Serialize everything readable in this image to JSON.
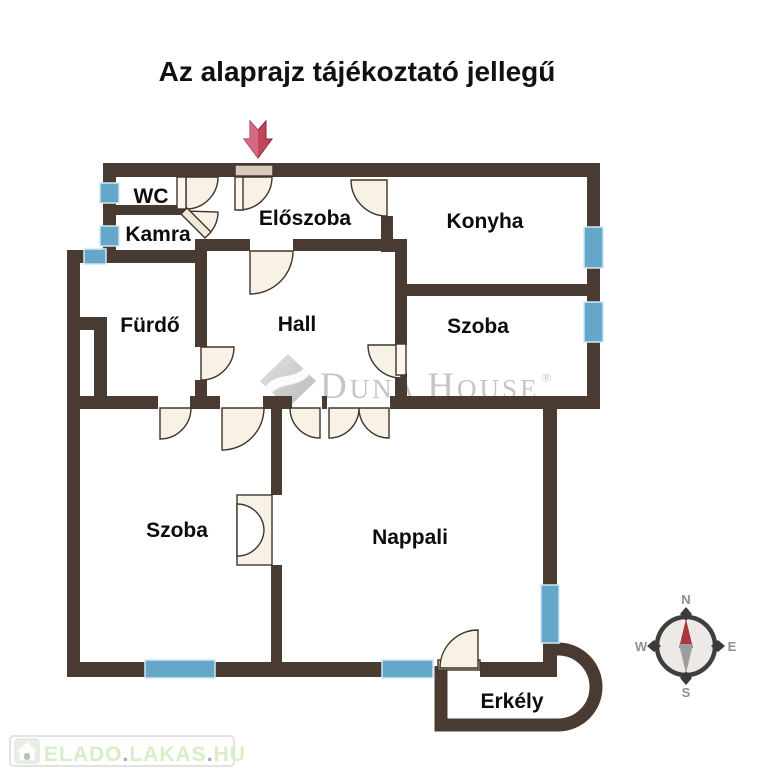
{
  "title": "Az alaprajz tájékoztató jellegű",
  "rooms": [
    {
      "label": "WC"
    },
    {
      "label": "Kamra"
    },
    {
      "label": "Előszoba"
    },
    {
      "label": "Konyha"
    },
    {
      "label": "Fürdő"
    },
    {
      "label": "Hall"
    },
    {
      "label": "Szoba"
    },
    {
      "label": "Szoba"
    },
    {
      "label": "Nappali"
    },
    {
      "label": "Erkély"
    }
  ],
  "compass": {
    "n": "N",
    "e": "E",
    "s": "S",
    "w": "W"
  },
  "logo": {
    "d": "D",
    "una": "UNA",
    "h": "H",
    "ouse": "OUSE",
    "reg": "®"
  },
  "watermark": {
    "part1": "ELADO",
    "dot1": ".",
    "part2": "LAKAS",
    "dot2": ".",
    "part3": "HU"
  },
  "colors": {
    "wall": "#493b32",
    "window": "#64a7c8",
    "door_fill": "#f8f1e6",
    "arrow_red": "#c2455c",
    "watermark_green": "#d8eec6",
    "logo_gray": "#c7c5c3"
  }
}
